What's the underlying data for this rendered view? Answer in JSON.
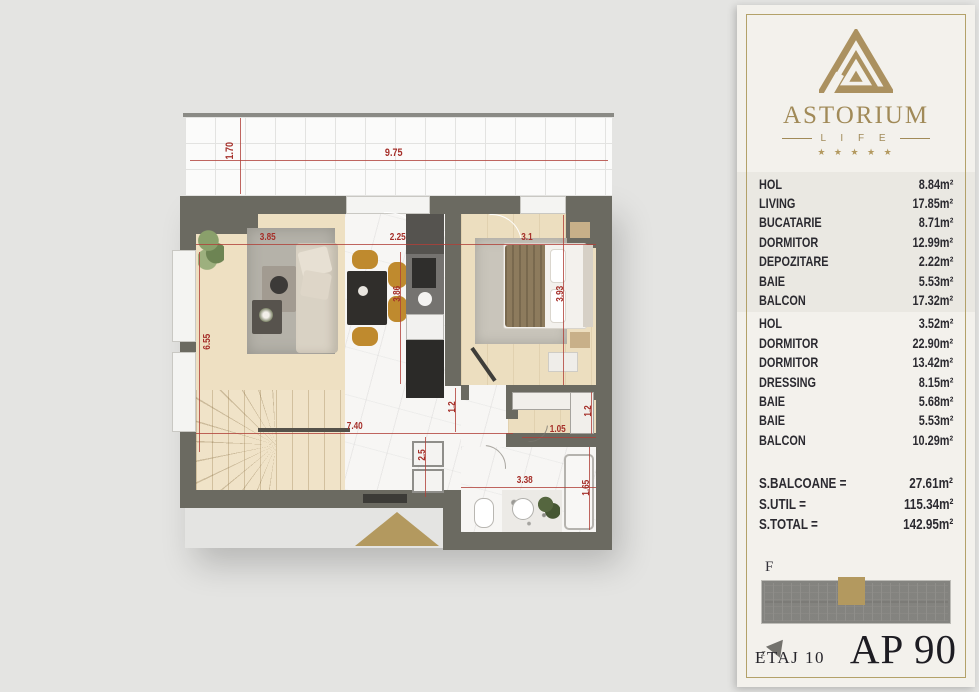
{
  "panel": {
    "brand": {
      "name": "ASTORIUM",
      "life": "L I F E",
      "stars": "★ ★ ★ ★ ★"
    },
    "rooms": {
      "group1": [
        {
          "label": "HOL",
          "value": "8.84m²"
        },
        {
          "label": "LIVING",
          "value": "17.85m²"
        },
        {
          "label": "BUCATARIE",
          "value": "8.71m²"
        },
        {
          "label": "DORMITOR",
          "value": "12.99m²"
        },
        {
          "label": "DEPOZITARE",
          "value": "2.22m²"
        },
        {
          "label": "BAIE",
          "value": "5.53m²"
        },
        {
          "label": "BALCON",
          "value": "17.32m²"
        }
      ],
      "group2": [
        {
          "label": "HOL",
          "value": "3.52m²"
        },
        {
          "label": "DORMITOR",
          "value": "22.90m²"
        },
        {
          "label": "DORMITOR",
          "value": "13.42m²"
        },
        {
          "label": "DRESSING",
          "value": "8.15m²"
        },
        {
          "label": "BAIE",
          "value": "5.68m²"
        },
        {
          "label": "BAIE",
          "value": "5.53m²"
        },
        {
          "label": "BALCON",
          "value": "10.29m²"
        }
      ]
    },
    "totals": [
      {
        "label": "S.BALCOANE =",
        "value": "27.61m²"
      },
      {
        "label": "S.UTIL =",
        "value": "115.34m²"
      },
      {
        "label": "S.TOTAL =",
        "value": "142.95m²"
      }
    ],
    "keyplan_label": "F",
    "compass_label": "z",
    "floor": "ETAJ 10",
    "unit": "AP 90"
  },
  "plan": {
    "dims": [
      {
        "text": "9.75"
      },
      {
        "text": "1.70"
      },
      {
        "text": "3.85"
      },
      {
        "text": "2.25"
      },
      {
        "text": "3.1"
      },
      {
        "text": "6.55"
      },
      {
        "text": "3.86"
      },
      {
        "text": "3.93"
      },
      {
        "text": "7.40"
      },
      {
        "text": "1.2"
      },
      {
        "text": "2.5"
      },
      {
        "text": "1.05"
      },
      {
        "text": "1.2"
      },
      {
        "text": "3.38"
      },
      {
        "text": "1.65"
      }
    ]
  },
  "colors": {
    "gold": "#ab9160",
    "wall": "#6b6a61",
    "dim_red": "#a52f29"
  }
}
